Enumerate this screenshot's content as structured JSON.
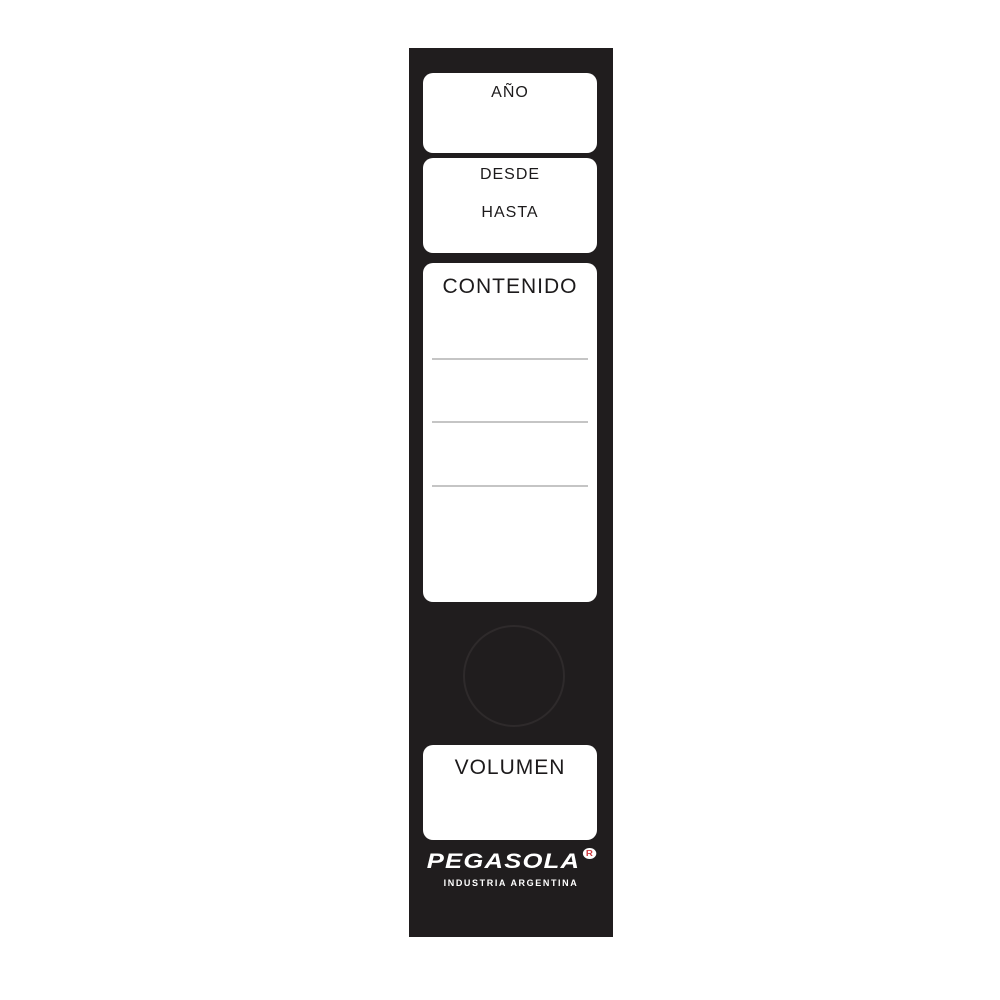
{
  "spine": {
    "fields": {
      "year_label": "AÑO",
      "from_label": "DESDE",
      "to_label": "HASTA",
      "content_label": "CONTENIDO",
      "volume_label": "VOLUMEN"
    },
    "content_ruled_lines": 3
  },
  "brand": {
    "name": "PEGASOLA",
    "registered_mark": "R",
    "tagline": "INDUSTRIA ARGENTINA"
  },
  "colors": {
    "spine_black": "#201d1e",
    "field_white": "#ffffff",
    "ruled_line": "#c5c5c5",
    "circle_outline": "#2e2a2b",
    "label_text": "#1c1a1b",
    "registered_red": "#cf3b41"
  }
}
